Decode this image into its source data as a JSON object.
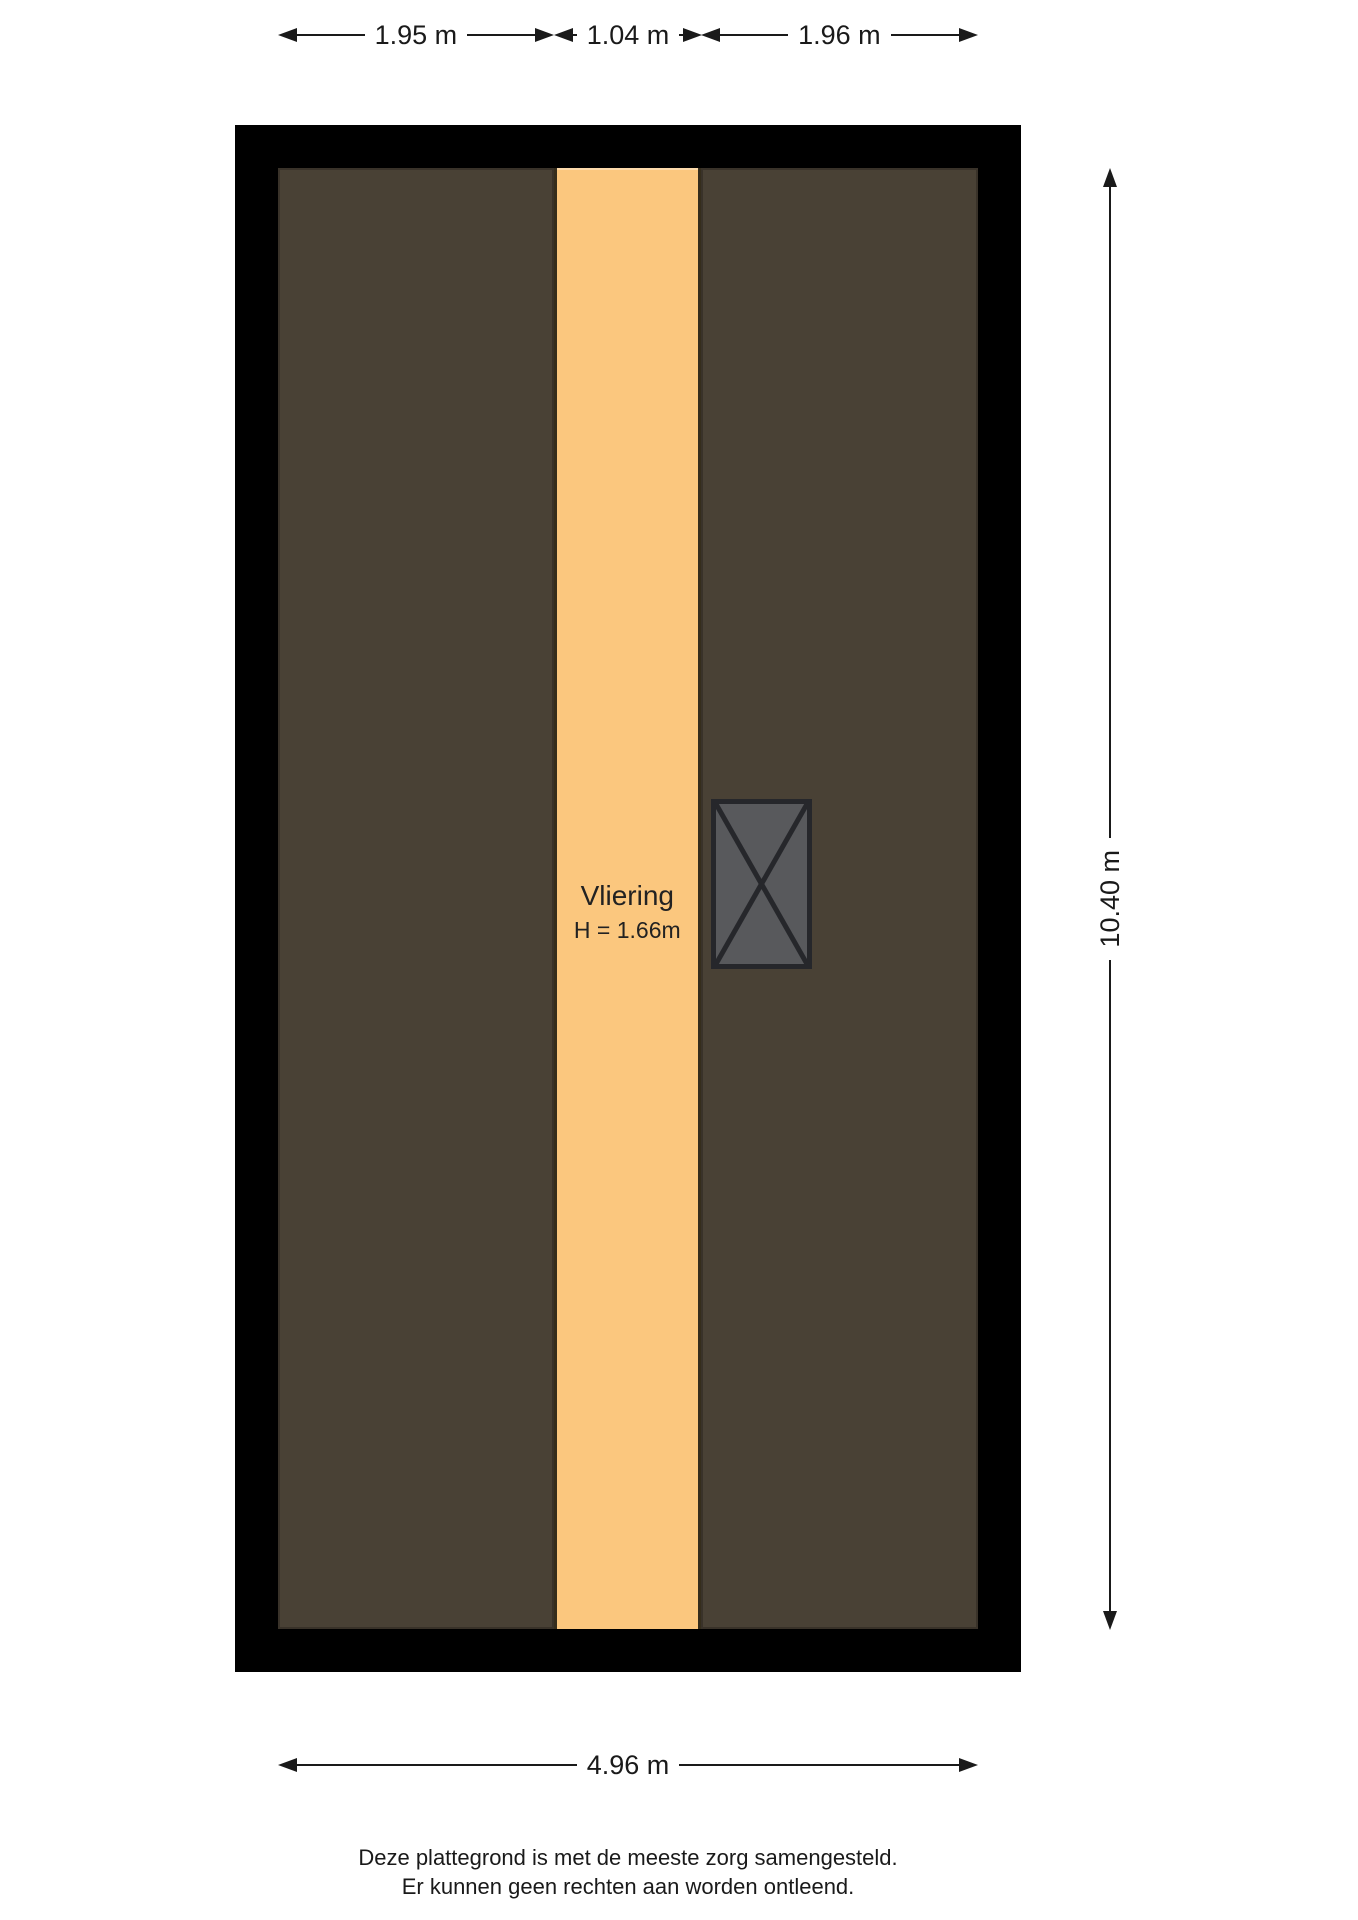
{
  "plan": {
    "room": {
      "name": "Vliering",
      "height_label": "H = 1.66m"
    },
    "dimensions": {
      "top_segments": [
        {
          "label": "1.95 m"
        },
        {
          "label": "1.04 m"
        },
        {
          "label": "1.96 m"
        }
      ],
      "right": {
        "label": "10.40 m"
      },
      "bottom": {
        "label": "4.96 m"
      }
    },
    "colors": {
      "wall": "#000000",
      "roof_area": "#494135",
      "loft_floor": "#fbc77e",
      "stair_fill": "#58595c",
      "stair_border": "#26272b",
      "dimension_line": "#1a1a1a",
      "label_text": "#222222"
    }
  },
  "footer": {
    "line1": "Deze plattegrond is met de meeste zorg samengesteld.",
    "line2": "Er kunnen geen rechten aan worden ontleend."
  }
}
